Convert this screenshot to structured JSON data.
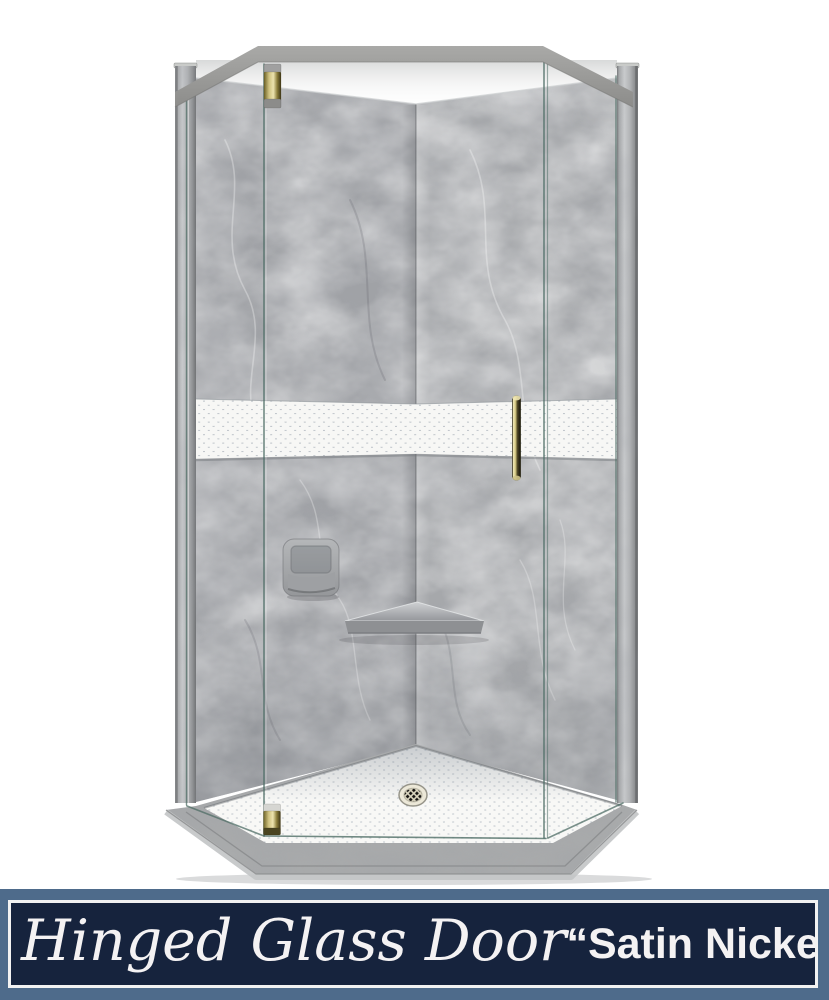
{
  "banner": {
    "script_text": "Hinged Glass Door",
    "finish_text": "“Satin Nickel”",
    "colors": {
      "background": "#16233d",
      "frame_outer": "#4e6b8b",
      "frame_inner_border": "#f2f2f2",
      "text": "#f4f2f3"
    }
  },
  "product_visual": {
    "description": "Neo-angle corner shower: grey marble walls, white hex accent band, white hex tile floor pan with center drain, hinged glass door with satin-nickel (brass-toned) hinges and handle, grey header bar and corner posts",
    "parts": [
      "header-bar",
      "left-post",
      "right-post",
      "left-wall",
      "right-wall",
      "accent-tile-band",
      "glass-door",
      "top-hinge",
      "bottom-hinge",
      "door-handle",
      "soap-dish",
      "corner-shelf",
      "tile-floor",
      "drain",
      "curb"
    ],
    "colors": {
      "wall_marble": "#a4a6a9",
      "accent_grout": "#9aa3ae",
      "floor_grout": "#95a0ad",
      "tile_white": "#f7f7f5",
      "hardware_brass": "#d9cd87",
      "glass_edge": "#4f6e66",
      "frame_gray": "#9b9b99"
    }
  }
}
